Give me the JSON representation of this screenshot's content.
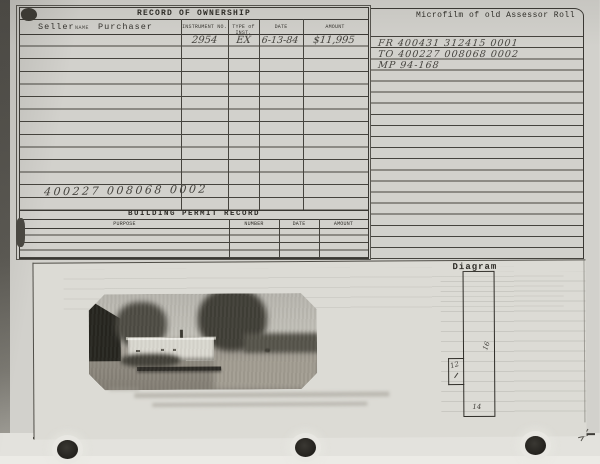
{
  "ownership": {
    "title": "RECORD OF OWNERSHIP",
    "headers": {
      "seller": "Seller",
      "name_sub": "NAME",
      "purchaser": "Purchaser",
      "instrument": "INSTRUMENT NO.",
      "type": "TYPE of INST.",
      "date": "DATE",
      "amount": "AMOUNT"
    },
    "entry": {
      "instrument_no": "2954",
      "type_of_inst": "EX",
      "date": "6-13-84",
      "amount": "$11,995"
    },
    "parcel_note": "400227 008068 0002"
  },
  "microfilm": {
    "title": "Microfilm of old Assessor Roll",
    "lines": [
      "FR 400431 312415 0001",
      "TO 400227 008068 0002",
      "MP 94-168"
    ]
  },
  "permits": {
    "title": "BUILDING PERMIT RECORD",
    "headers": [
      "PURPOSE",
      "NUMBER",
      "DATE",
      "AMOUNT"
    ]
  },
  "diagram": {
    "label": "Diagram",
    "dim_right": "16",
    "dim_small": "12",
    "dim_bottom": "14"
  },
  "photo": {
    "alt": "Black-and-white photograph of a single-wide mobile home among trees with a dirt yard"
  }
}
